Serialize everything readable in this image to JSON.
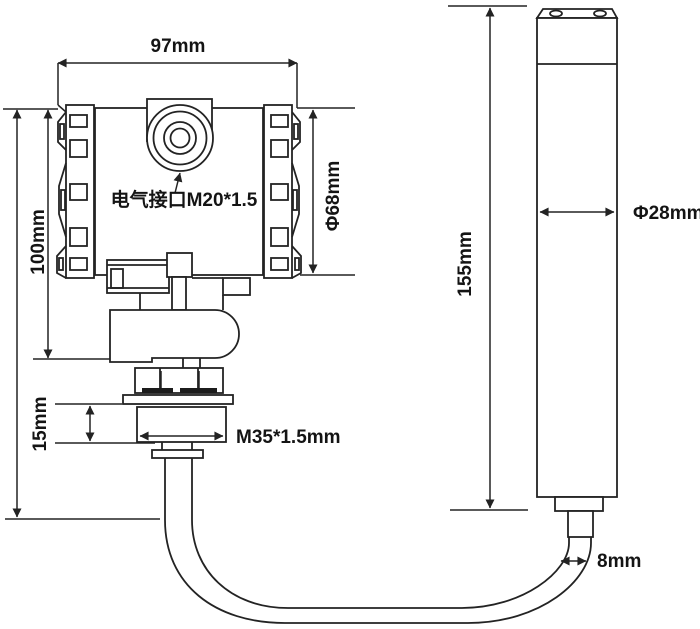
{
  "diagram": {
    "type": "technical-dimension-drawing",
    "subject": "submersible-level-transmitter-with-probe",
    "background_color": "#ffffff",
    "line_color": "#232323",
    "labels": {
      "head_width": "97mm",
      "head_height": "100mm",
      "head_diameter": "Φ68mm",
      "electrical_port": "电气接口M20*1.5",
      "thread_height": "15mm",
      "thread_spec": "M35*1.5mm",
      "probe_length": "155mm",
      "probe_diameter": "Φ28mm",
      "cable_diameter": "8mm"
    }
  }
}
